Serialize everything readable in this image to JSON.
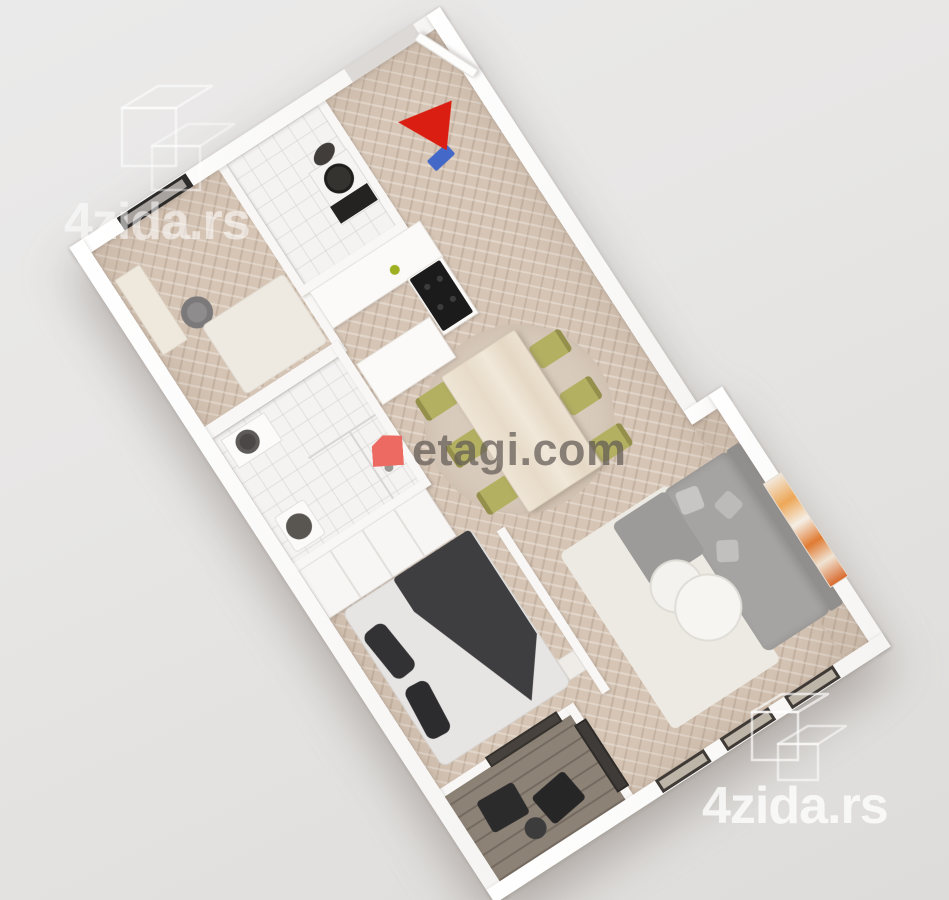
{
  "watermarks": {
    "top_left": {
      "text": "4zida.rs",
      "logo": "4zida-outline-logo"
    },
    "center": {
      "text": "etagi.com",
      "logo": "etagi-red-logo",
      "logo_color": "#ec6a61"
    },
    "bottom_right": {
      "text": "4zida.rs",
      "logo": "4zida-outline-logo"
    }
  },
  "scene": {
    "type": "3d-apartment-floor-plan-render",
    "view": "top-down 3d render rotated about -33 degrees",
    "entry_arrow_color": "#da1f12",
    "palette": {
      "background_top": "#ebeaea",
      "background_bottom": "#dedcda",
      "walls": "#fbfaf9",
      "parquet_floor": "#d6c5b5",
      "bathroom_tile": "#f4f3f2",
      "balcony_floor": "#8d8276",
      "sofa_gray": "#a6a4a2",
      "dining_chair_olive": "#b3b062",
      "bed_blanket_dark": "#3e3e41",
      "stove_black": "#1c1b1b",
      "doormat_blue": "#4468c8"
    },
    "rooms": [
      {
        "name": "office",
        "items": [
          "wall-window",
          "desk",
          "office-chair",
          "light-rug"
        ]
      },
      {
        "name": "wc",
        "items": [
          "washer-toilet-unit"
        ]
      },
      {
        "name": "entry-hall",
        "items": [
          "entrance-door-open",
          "entry-direction-arrow",
          "blue-doormat"
        ]
      },
      {
        "name": "kitchen",
        "items": [
          "counter-run",
          "island",
          "black-stove",
          "green-plant"
        ]
      },
      {
        "name": "bathroom",
        "items": [
          "vanity-sink",
          "toilet",
          "glass-shower"
        ]
      },
      {
        "name": "wardrobe-nook",
        "items": [
          "built-in-closet"
        ]
      },
      {
        "name": "bedroom",
        "items": [
          "double-bed",
          "dark-pillows",
          "dark-blanket",
          "nightstand"
        ]
      },
      {
        "name": "living-dining",
        "items": [
          "dining-table",
          "six-olive-chairs",
          "round-rug",
          "corner-sofa",
          "sofa-pillows",
          "two-round-coffee-tables",
          "orange-artwork",
          "three-windows"
        ]
      },
      {
        "name": "balcony",
        "items": [
          "two-lounge-chairs",
          "side-table",
          "dark-glass-doors"
        ]
      }
    ]
  }
}
